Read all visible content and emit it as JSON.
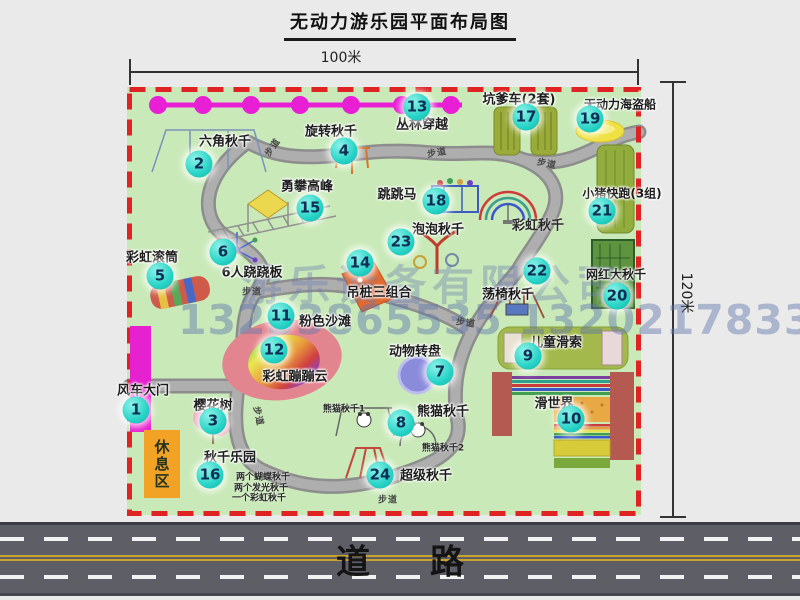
{
  "title": "无动力游乐园平面布局图",
  "dimensions": {
    "width_label": "100米",
    "height_label": "120米"
  },
  "road": {
    "label": "道路"
  },
  "watermark": {
    "company": "游乐设备有限公司",
    "phone": "13233865535 13202178333"
  },
  "rest_area": {
    "label": "休息区"
  },
  "colors": {
    "park_green": "#c9e9b8",
    "border_red": "#e02222",
    "badge_teal": "#27d4c7",
    "gate_magenta": "#e621cf",
    "road_gray": "#5e5e66",
    "rest_orange": "#f2a225"
  },
  "attractions": [
    {
      "n": 1,
      "key": "windmill-gate",
      "label": "风车大门",
      "bx": 136,
      "by": 410,
      "lx": 143,
      "ly": 389
    },
    {
      "n": 2,
      "key": "hexagon-swing",
      "label": "六角秋千",
      "bx": 199,
      "by": 164,
      "lx": 225,
      "ly": 140
    },
    {
      "n": 3,
      "key": "cherry-tree",
      "label": "樱花树",
      "bx": 213,
      "by": 421,
      "lx": 213,
      "ly": 404
    },
    {
      "n": 4,
      "key": "rotary-swing",
      "label": "旋转秋千",
      "bx": 344,
      "by": 151,
      "lx": 331,
      "ly": 130
    },
    {
      "n": 5,
      "key": "rainbow-roller",
      "label": "彩虹滚筒",
      "bx": 160,
      "by": 276,
      "lx": 152,
      "ly": 256
    },
    {
      "n": 6,
      "key": "six-seesaw",
      "label": "6人跷跷板",
      "bx": 223,
      "by": 252,
      "lx": 252,
      "ly": 271
    },
    {
      "n": 7,
      "key": "animal-carousel",
      "label": "动物转盘",
      "bx": 440,
      "by": 372,
      "lx": 415,
      "ly": 350
    },
    {
      "n": 8,
      "key": "panda-swing",
      "label": "熊猫秋千",
      "bx": 401,
      "by": 423,
      "lx": 443,
      "ly": 410
    },
    {
      "n": 9,
      "key": "kids-zipline",
      "label": "儿童滑索",
      "bx": 528,
      "by": 356,
      "lx": 556,
      "ly": 341
    },
    {
      "n": 10,
      "key": "slide-world",
      "label": "滑世界",
      "bx": 571,
      "by": 419,
      "lx": 554,
      "ly": 402
    },
    {
      "n": 11,
      "key": "pink-beach",
      "label": "粉色沙滩",
      "bx": 281,
      "by": 316,
      "lx": 325,
      "ly": 320
    },
    {
      "n": 12,
      "key": "rainbow-bounce-cloud",
      "label": "彩虹蹦蹦云",
      "bx": 274,
      "by": 350,
      "lx": 295,
      "ly": 375
    },
    {
      "n": 13,
      "key": "jungle-crossing",
      "label": "丛林穿越",
      "bx": 417,
      "by": 107,
      "lx": 422,
      "ly": 123
    },
    {
      "n": 14,
      "key": "hanging-post-combo",
      "label": "吊桩三组合",
      "bx": 360,
      "by": 263,
      "lx": 379,
      "ly": 291
    },
    {
      "n": 15,
      "key": "peak-climbing",
      "label": "勇攀高峰",
      "bx": 310,
      "by": 208,
      "lx": 307,
      "ly": 185
    },
    {
      "n": 16,
      "key": "swing-park",
      "label": "秋千乐园",
      "bx": 210,
      "by": 475,
      "lx": 230,
      "ly": 456
    },
    {
      "n": 17,
      "key": "kengdie-car",
      "label": "坑爹车(2套)",
      "bx": 526,
      "by": 117,
      "lx": 519,
      "ly": 98
    },
    {
      "n": 18,
      "key": "jumping-horse",
      "label": "跳跳马",
      "bx": 436,
      "by": 201,
      "lx": 397,
      "ly": 193
    },
    {
      "n": 19,
      "key": "pirate-ship",
      "label": "无动力海盗船",
      "bx": 590,
      "by": 119,
      "lx": 620,
      "ly": 104,
      "fs": 12
    },
    {
      "n": 20,
      "key": "big-swing",
      "label": "网红大秋千",
      "bx": 617,
      "by": 296,
      "lx": 616,
      "ly": 274,
      "fs": 12
    },
    {
      "n": 21,
      "key": "pig-run",
      "label": "小猪快跑(3组)",
      "bx": 602,
      "by": 211,
      "lx": 622,
      "ly": 193,
      "fs": 12
    },
    {
      "n": 22,
      "key": "chair-swing",
      "label": "荡椅秋千",
      "bx": 537,
      "by": 271,
      "lx": 508,
      "ly": 293
    },
    {
      "n": 23,
      "key": "bubble-swing",
      "label": "泡泡秋千",
      "bx": 401,
      "by": 242,
      "lx": 438,
      "ly": 228
    },
    {
      "n": 24,
      "key": "super-swing",
      "label": "超级秋千",
      "bx": 380,
      "by": 475,
      "lx": 426,
      "ly": 474
    }
  ],
  "extra_labels": [
    {
      "key": "rainbow-swing",
      "text": "彩虹秋千",
      "x": 538,
      "y": 224,
      "fs": 13,
      "bold": true
    },
    {
      "key": "panda-swing-1",
      "text": "熊猫秋千1",
      "x": 344,
      "y": 408,
      "fs": 9
    },
    {
      "key": "panda-swing-2",
      "text": "熊猫秋千2",
      "x": 443,
      "y": 447,
      "fs": 9
    },
    {
      "key": "swing-note-1",
      "text": "两个蝴蝶秋千",
      "x": 263,
      "y": 476,
      "fs": 9
    },
    {
      "key": "swing-note-2",
      "text": "两个发光秋千",
      "x": 261,
      "y": 487,
      "fs": 9
    },
    {
      "key": "swing-note-3",
      "text": "一个彩虹秋千",
      "x": 259,
      "y": 497,
      "fs": 9
    }
  ],
  "walkway_labels": [
    {
      "text": "步道",
      "x": 272,
      "y": 147,
      "rot": -55
    },
    {
      "text": "步道",
      "x": 437,
      "y": 152,
      "rot": -10
    },
    {
      "text": "步道",
      "x": 547,
      "y": 163,
      "rot": 12
    },
    {
      "text": "步道",
      "x": 252,
      "y": 291,
      "rot": 0
    },
    {
      "text": "步道",
      "x": 466,
      "y": 322,
      "rot": 8
    },
    {
      "text": "步道",
      "x": 388,
      "y": 499,
      "rot": 0
    },
    {
      "text": "步道",
      "x": 259,
      "y": 416,
      "rot": 78
    }
  ]
}
